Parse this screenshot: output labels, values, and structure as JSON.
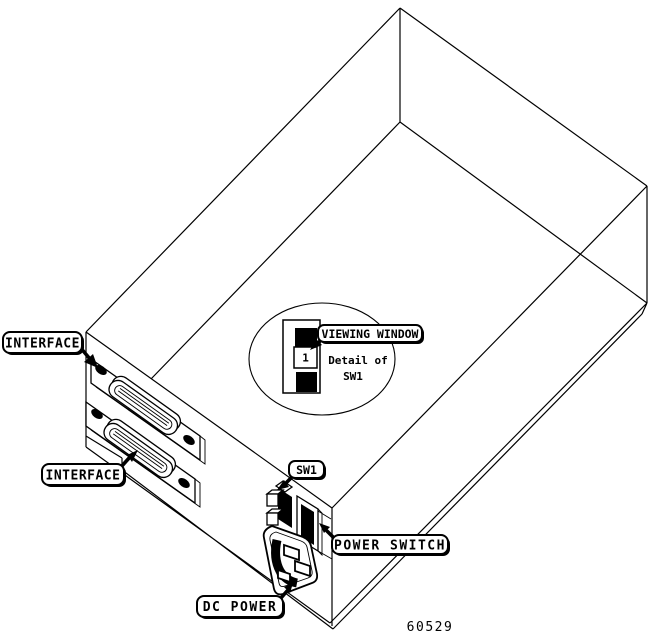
{
  "figure": {
    "number": "60529"
  },
  "callouts": {
    "interface_top": "INTERFACE",
    "interface_bottom": "INTERFACE",
    "viewing_window": "VIEWING WINDOW",
    "sw1": "SW1",
    "power_switch": "POWER SWITCH",
    "dc_power": "DC POWER"
  },
  "detail": {
    "caption_line1": "Detail of",
    "caption_line2": "SW1",
    "switch_position": "1"
  },
  "colors": {
    "ink": "#000000",
    "paper": "#ffffff"
  }
}
